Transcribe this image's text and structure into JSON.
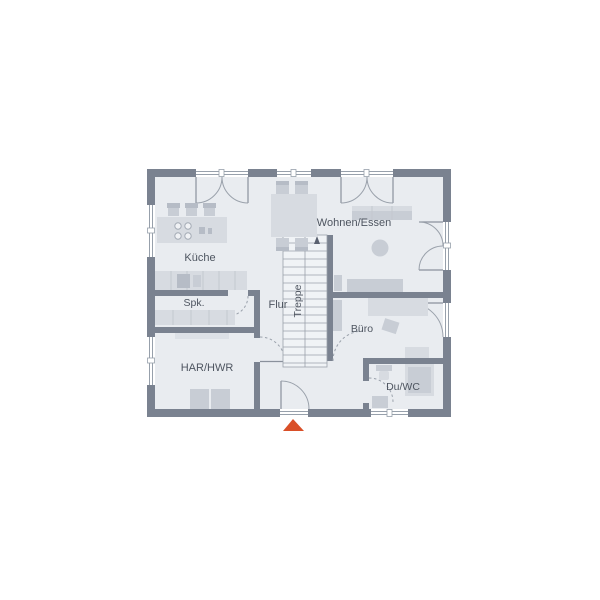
{
  "colors": {
    "background": "#ffffff",
    "wall": "#7a8290",
    "floor": "#e9ecf0",
    "stair_floor": "#f0f3f6",
    "furniture_light": "#d7dbe1",
    "furniture_mid": "#c8cdd5",
    "furniture_dark": "#b6bcc6",
    "outline": "#97a0ab",
    "label_text": "#4e5560",
    "entrance_accent": "#d94f28"
  },
  "rooms": {
    "kueche": {
      "label": "Küche"
    },
    "spk": {
      "label": "Spk."
    },
    "flur": {
      "label": "Flur"
    },
    "treppe": {
      "label": "Treppe"
    },
    "wohnen_essen": {
      "label": "Wohnen/Essen"
    },
    "buero": {
      "label": "Büro"
    },
    "har_hwr": {
      "label": "HAR/HWR"
    },
    "du_wc": {
      "label": "Du/WC"
    }
  },
  "markers": {
    "entrance_icon": "entrance-arrow",
    "stair_direction_icon": "stair-up-arrow"
  }
}
